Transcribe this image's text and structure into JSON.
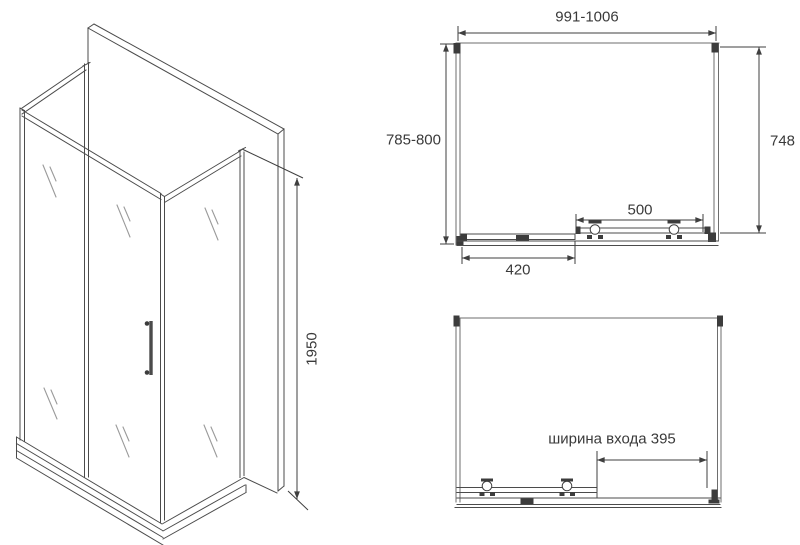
{
  "title": "shower-enclosure-technical-drawing",
  "colors": {
    "background": "#ffffff",
    "frame_line": "#4b4b4b",
    "light_line": "#9a9a9a",
    "dimension_line": "#3f3f3f",
    "text": "#3a3a3a"
  },
  "drawing_labels": {
    "iso_height": "1950",
    "plan_width_range": "991-1006",
    "plan_depth_range": "785-800",
    "plan_side_depth": "748",
    "plan_door_width": "500",
    "plan_fixed_panel_width": "420",
    "front_entrance_width": "ширина входа 395"
  }
}
